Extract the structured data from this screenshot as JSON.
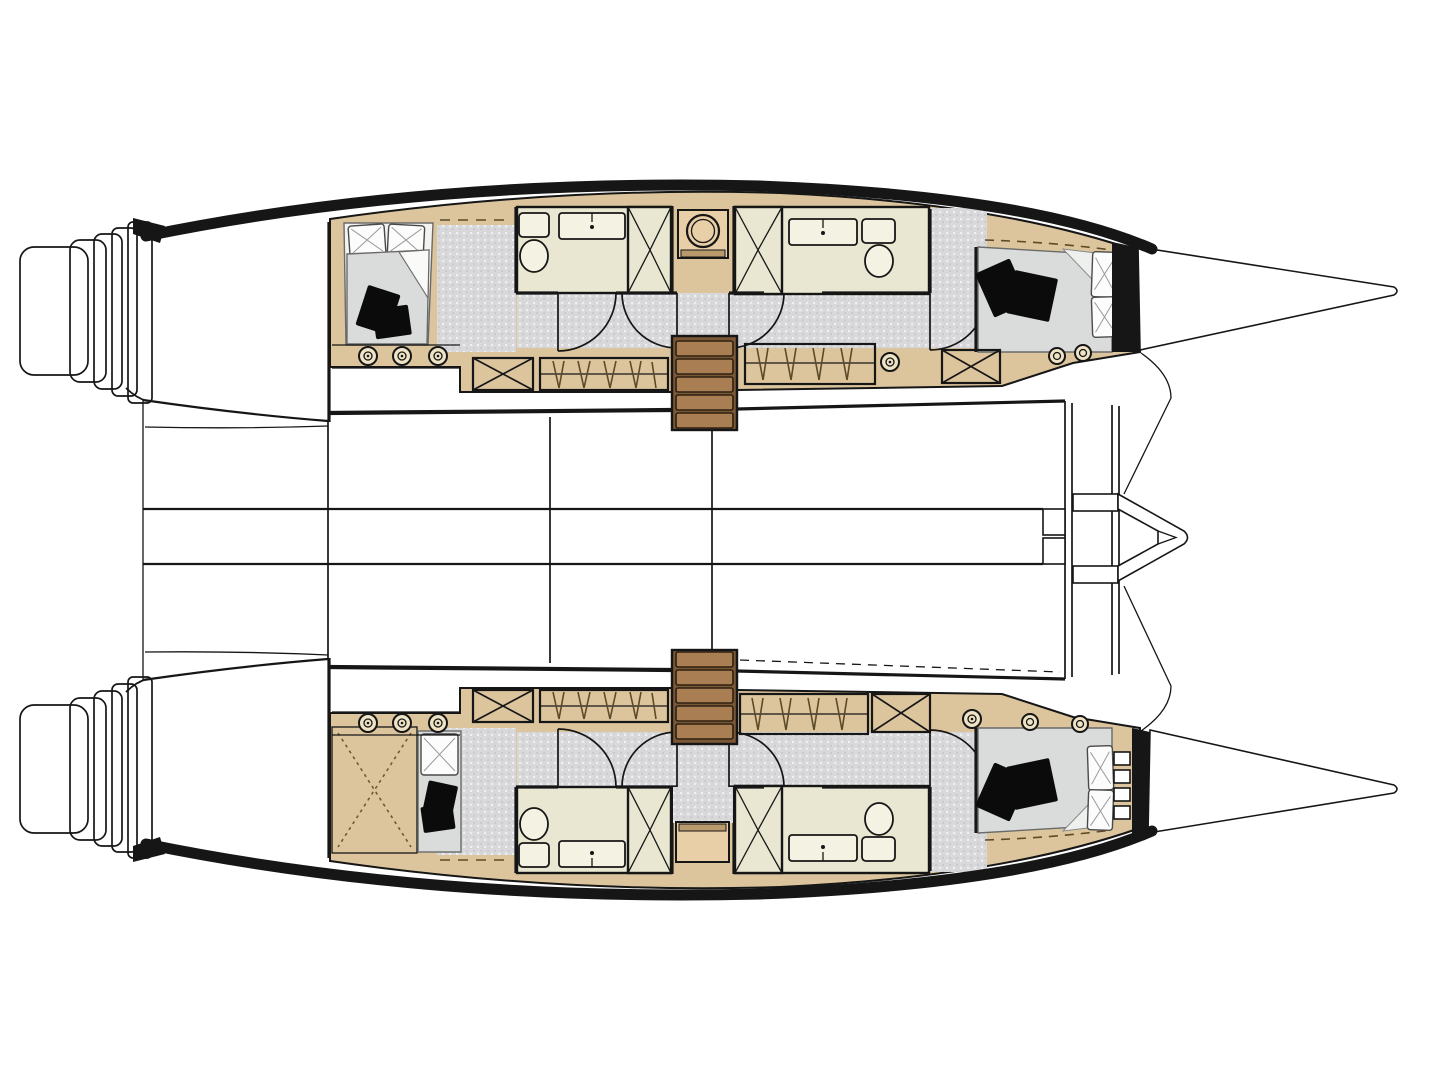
{
  "meta": {
    "diagram_type": "catamaran-interior-deck-plan",
    "view": "top-down"
  },
  "colors": {
    "ink": "#161616",
    "tan": "#dcc59d",
    "tanLight": "#e9cfa7",
    "cream": "#e9e7d1",
    "fixture": "#f4f2e2",
    "floor": "#d8d8db",
    "floorLight": "#edeff0",
    "floorDark": "#c7c8cc",
    "bedGray": "#d9dcdb",
    "pillow": "#fcfcfc",
    "cushion": "#0b0b0b",
    "stairTread": "#a97e52",
    "stairFrame": "#7a5836",
    "stairEdge": "#2e2012",
    "grateDark": "#3a3a3a",
    "grateLight": "#f2f2f2",
    "portholeRim": "#efe3c6",
    "drawer": "#b99a6d"
  },
  "vessel": {
    "hulls": [
      {
        "name": "port-hull",
        "position": "top",
        "features": [
          "swim-steps",
          "aft-double-berth",
          "two-bathrooms",
          "shower-stalls",
          "washer-console",
          "companionway-stairs",
          "hanging-lockers",
          "storage-lockers",
          "portholes",
          "forward-double-berth",
          "bow"
        ]
      },
      {
        "name": "starboard-hull",
        "position": "bottom",
        "features": [
          "swim-steps",
          "technical-area",
          "single-berth",
          "two-bathrooms",
          "shower-stalls",
          "console",
          "companionway-stairs",
          "hanging-lockers",
          "storage-lockers",
          "portholes",
          "forward-double-berth",
          "bow"
        ]
      }
    ],
    "bridge_deck": {
      "features": [
        "aft-transom-pockets",
        "central-walkway",
        "deck-seams",
        "mast-step-blocks",
        "forward-crossbeam",
        "bowsprit"
      ]
    }
  }
}
